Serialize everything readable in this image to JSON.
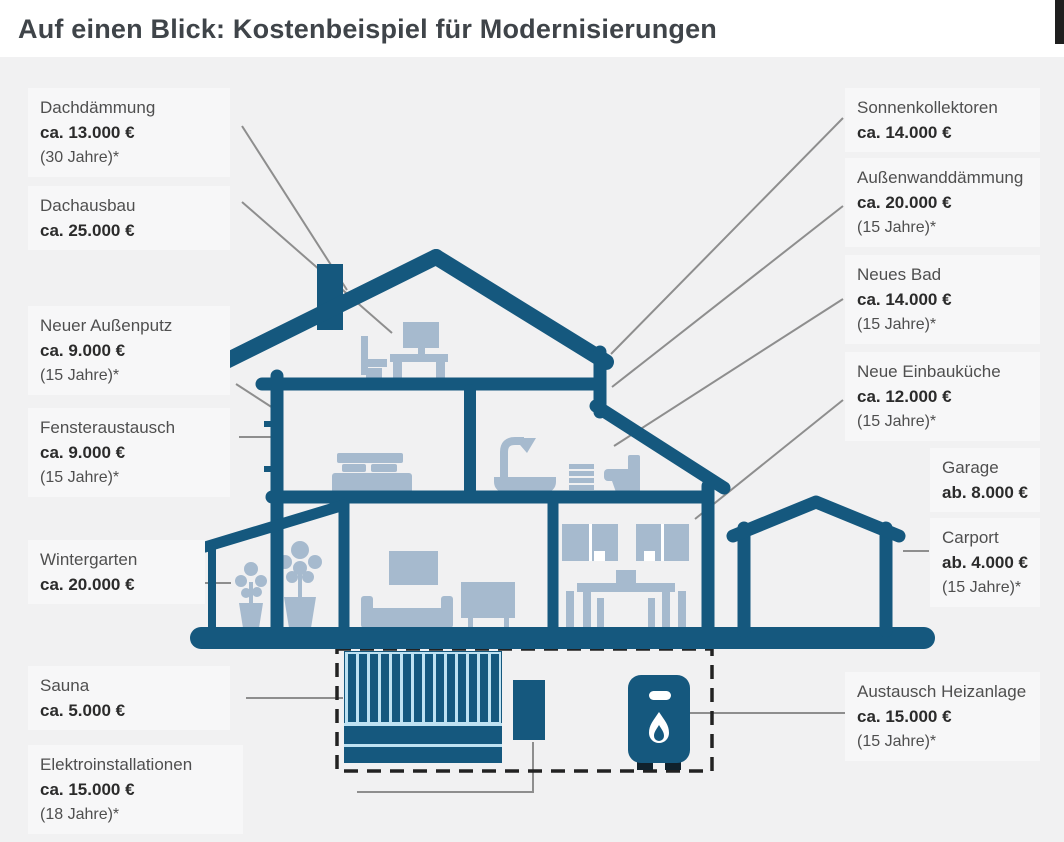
{
  "title": "Auf einen Blick: Kostenbeispiel für Modernisierungen",
  "colors": {
    "house_teal": "#15587E",
    "furniture_blue_gray": "#A6BACE",
    "sauna_stripe_light_blue": "#BFE2F2",
    "connector_line_gray": "#8E8E8E",
    "page_background": "#F1F1F2",
    "label_background": "#F7F7F8",
    "title_text": "#3F4449"
  },
  "diagram_description": "cross-section-of-house-with-cost-annotations",
  "labels": {
    "left": [
      {
        "name": "Dachdämmung",
        "price": "ca. 13.000 €",
        "years": "(30 Jahre)*"
      },
      {
        "name": "Dachausbau",
        "price": "ca. 25.000 €"
      },
      {
        "name": "Neuer Außenputz",
        "price": "ca. 9.000 €",
        "years": "(15 Jahre)*"
      },
      {
        "name": "Fensteraustausch",
        "price": "ca. 9.000 €",
        "years": "(15 Jahre)*"
      },
      {
        "name": "Wintergarten",
        "price": "ca. 20.000 €"
      },
      {
        "name": "Sauna",
        "price": "ca. 5.000 €"
      },
      {
        "name": "Elektroinstallationen",
        "price": "ca. 15.000 €",
        "years": "(18 Jahre)*"
      }
    ],
    "right": [
      {
        "name": "Sonnenkollektoren",
        "price": "ca. 14.000 €"
      },
      {
        "name": "Außenwanddämmung",
        "price": "ca. 20.000 €",
        "years": "(15 Jahre)*"
      },
      {
        "name": "Neues Bad",
        "price": "ca. 14.000 €",
        "years": "(15 Jahre)*"
      },
      {
        "name": "Neue Einbauküche",
        "price": "ca. 12.000 €",
        "years": "(15 Jahre)*"
      },
      {
        "name": "Garage",
        "price": "ab. 8.000 €"
      },
      {
        "name": "Carport",
        "price": "ab. 4.000 €",
        "years": "(15 Jahre)*"
      },
      {
        "name": "Austausch Heizanlage",
        "price": "ca. 15.000 €",
        "years": "(15 Jahre)*"
      }
    ]
  }
}
